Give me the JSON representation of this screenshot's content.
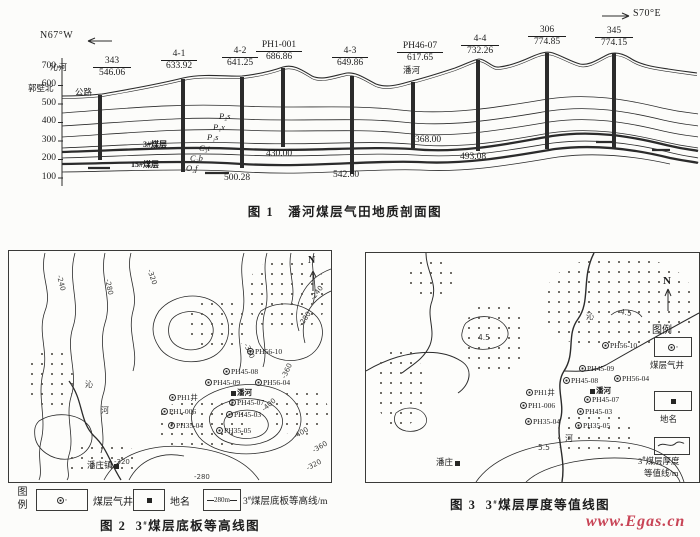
{
  "figure1": {
    "caption": "图 1　潘河煤层气田地质剖面图",
    "dir_left": "N67°W",
    "dir_right": "S70°E",
    "axis_ticks": [
      "700",
      "600",
      "500",
      "400",
      "300",
      "200",
      "100"
    ],
    "river": "沁河",
    "place_left1": "郭壁北",
    "place_left2": "公路",
    "place_mid": "潘河",
    "seam3": "3#煤层",
    "seam15": "15#煤层",
    "strata": [
      "P₂s",
      "P₁x",
      "P₁s",
      "C₃t",
      "C₂b",
      "O₂f"
    ],
    "wells": [
      {
        "name": "343",
        "elev": "546.06"
      },
      {
        "name": "4-1",
        "elev": "633.92"
      },
      {
        "name": "4-2",
        "elev": "641.25"
      },
      {
        "name": "PH1-001",
        "elev": "686.86"
      },
      {
        "name": "4-3",
        "elev": "649.86"
      },
      {
        "name": "PH46-07",
        "elev": "617.65"
      },
      {
        "name": "4-4",
        "elev": "732.26"
      },
      {
        "name": "306",
        "elev": "774.85"
      },
      {
        "name": "345",
        "elev": "774.15"
      }
    ],
    "depths": [
      "500.28",
      "430.00",
      "542.60",
      "368.00",
      "493.08"
    ]
  },
  "figure2": {
    "caption_label": "图 2",
    "caption_pre": "3",
    "caption_sup": "#",
    "caption_post": "煤层底板等高线图",
    "north": "N",
    "legend": {
      "header": "图例",
      "well_label": "煤层气井",
      "place_label": "地名",
      "contour_symbol": "280m",
      "contour_pre": "3",
      "contour_sup": "#",
      "contour_post": "煤层底板等高线/m"
    },
    "contour_labels": [
      "-240",
      "-280",
      "-320",
      "-240",
      "-280",
      "-360",
      "-400",
      "-400",
      "-360",
      "-320",
      "-320",
      "-280",
      "-360"
    ],
    "wells": [
      "PH56-10",
      "PH45-08",
      "PH45-09",
      "PH56-04",
      "PH45-07",
      "PH45-03",
      "PH1井",
      "PH1-006",
      "PH35-04",
      "PH35-05"
    ],
    "place": "潘河",
    "town": "潘庄镇",
    "river_chars": [
      "沁",
      "河"
    ]
  },
  "figure3": {
    "caption_label": "图 3",
    "caption_pre": "3",
    "caption_sup": "#",
    "caption_post": "煤层厚度等值线图",
    "north": "N",
    "legend": {
      "header": "图例",
      "well_label": "煤层气井",
      "place_label": "地名",
      "contour_line1_pre": "3",
      "contour_line1_sup": "#",
      "contour_line1_post": "煤层厚度",
      "contour_line2": "等值线/m"
    },
    "contour_labels": [
      "4.5",
      "4.5",
      "5.5"
    ],
    "wells": [
      "PH56-10",
      "PH45-09",
      "PH45-08",
      "PH56-04",
      "PH45-07",
      "PH45-03",
      "PH1井",
      "PH1-006",
      "PH35-04",
      "PH35-05"
    ],
    "place": "潘河",
    "town": "潘庄",
    "river_chars": [
      "沁",
      "河"
    ]
  },
  "watermark": {
    "text": "www.Egas.cn",
    "color": "#c84456"
  }
}
